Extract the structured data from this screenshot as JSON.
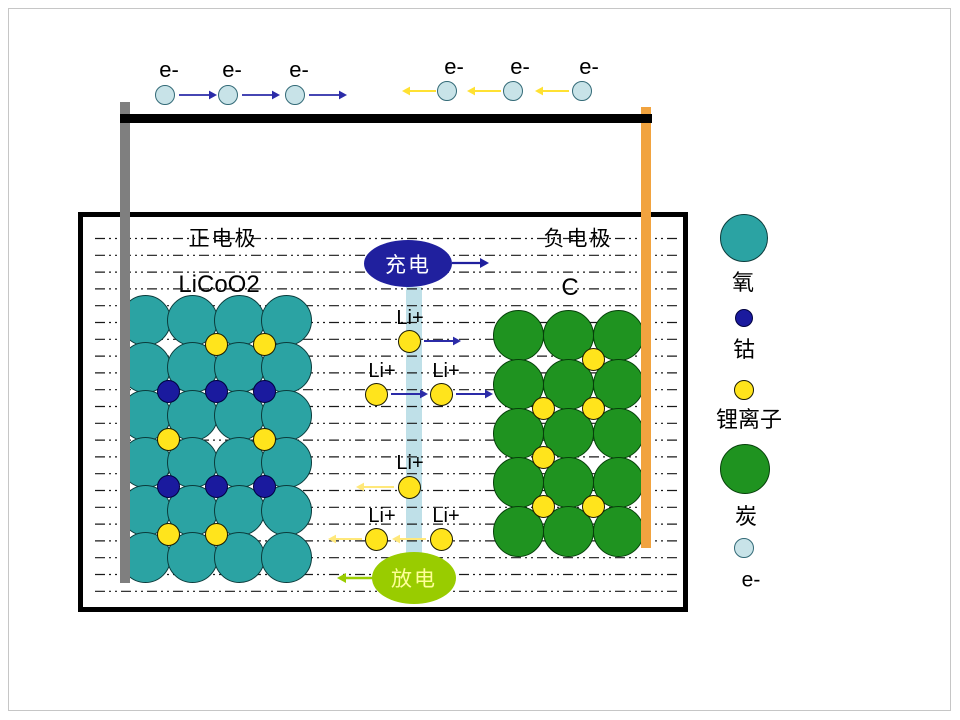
{
  "labels": {
    "positive_title": "正电极",
    "positive_formula": "LiCoO2",
    "negative_title": "负电极",
    "negative_formula": "C",
    "charge": "充电",
    "discharge": "放电",
    "ion": "Li+",
    "electron": "e-"
  },
  "colors": {
    "wire": "#000000",
    "collector_left": "#7F7F7F",
    "collector_right": "#F1A33F",
    "separator": "#BFE0E8",
    "charge_fill": "#20209E",
    "charge_text": "#FFFFFF",
    "discharge_fill": "#99CC00",
    "discharge_text": "#FFFF99",
    "dash_line": "#1A1A1A",
    "oxygen": "#2BA3A3",
    "cobalt": "#1A1A9E",
    "lithium": "#FFE41C",
    "carbon": "#1F9320",
    "electron": "#C8E3E8"
  },
  "lattices": {
    "positive": {
      "atom": "oxygen-atom",
      "fill": "#2BA3A3",
      "stroke": "#0B3C3C",
      "r": 25.5,
      "cols": [
        145,
        192,
        239,
        286
      ],
      "rows": [
        320,
        367.5,
        415,
        462.5,
        510,
        557.5
      ],
      "interstitials": [
        {
          "x": 216,
          "y": 344,
          "type": "lithium-ion"
        },
        {
          "x": 264,
          "y": 344,
          "type": "lithium-ion"
        },
        {
          "x": 168,
          "y": 391.5,
          "type": "cobalt-atom"
        },
        {
          "x": 216,
          "y": 391.5,
          "type": "cobalt-atom"
        },
        {
          "x": 264,
          "y": 391.5,
          "type": "cobalt-atom"
        },
        {
          "x": 168,
          "y": 439,
          "type": "lithium-ion"
        },
        {
          "x": 264,
          "y": 439,
          "type": "lithium-ion"
        },
        {
          "x": 168,
          "y": 486.5,
          "type": "cobalt-atom"
        },
        {
          "x": 216,
          "y": 486.5,
          "type": "cobalt-atom"
        },
        {
          "x": 264,
          "y": 486.5,
          "type": "cobalt-atom"
        },
        {
          "x": 168,
          "y": 534,
          "type": "lithium-ion"
        },
        {
          "x": 216,
          "y": 534,
          "type": "lithium-ion"
        }
      ]
    },
    "negative": {
      "atom": "carbon-atom",
      "fill": "#1F9320",
      "stroke": "#06400A",
      "r": 25.5,
      "cols": [
        518,
        568,
        618
      ],
      "rows": [
        335,
        384,
        433,
        482,
        531
      ],
      "interstitials": [
        {
          "x": 593,
          "y": 359.5,
          "type": "lithium-ion"
        },
        {
          "x": 543,
          "y": 408.5,
          "type": "lithium-ion"
        },
        {
          "x": 593,
          "y": 408.5,
          "type": "lithium-ion"
        },
        {
          "x": 543,
          "y": 457.5,
          "type": "lithium-ion"
        },
        {
          "x": 543,
          "y": 506.5,
          "type": "lithium-ion"
        },
        {
          "x": 593,
          "y": 506.5,
          "type": "lithium-ion"
        }
      ]
    }
  },
  "ion_styles": {
    "lithium-ion": {
      "fill": "#FFE41C",
      "stroke": "#1A1A00",
      "r": 11.5
    },
    "cobalt-atom": {
      "fill": "#1A1A9E",
      "stroke": "#00003F",
      "r": 11.5
    },
    "electron-circle": {
      "fill": "#C8E3E8",
      "stroke": "#336A77",
      "r": 10
    }
  },
  "electron_flow": {
    "left": {
      "circles": [
        [
          165,
          95
        ],
        [
          228,
          95
        ],
        [
          295,
          95
        ]
      ],
      "labels": [
        [
          169,
          70
        ],
        [
          232,
          70
        ],
        [
          299,
          70
        ]
      ]
    },
    "right": {
      "circles": [
        [
          447,
          91
        ],
        [
          513,
          91
        ],
        [
          582,
          91
        ]
      ],
      "labels": [
        [
          454,
          67
        ],
        [
          520,
          67
        ],
        [
          589,
          67
        ]
      ]
    }
  },
  "li_migration": {
    "charge": [
      {
        "lx": 410,
        "ly": 318,
        "cx": 409,
        "cy": 341
      },
      {
        "lx": 382,
        "ly": 371,
        "cx": 376,
        "cy": 394
      },
      {
        "lx": 446,
        "ly": 371,
        "cx": 441,
        "cy": 394
      }
    ],
    "discharge": [
      {
        "lx": 410,
        "ly": 463,
        "cx": 409,
        "cy": 487
      },
      {
        "lx": 382,
        "ly": 516,
        "cx": 376,
        "cy": 539
      },
      {
        "lx": 446,
        "ly": 516,
        "cx": 441,
        "cy": 539
      }
    ]
  },
  "arrows": [
    {
      "name": "electron-arrow-right",
      "x1": 179,
      "y1": 95,
      "x2": 217,
      "y2": 95,
      "color": "#2B2BA8",
      "w": 1.8,
      "head": 8
    },
    {
      "name": "electron-arrow-right",
      "x1": 242,
      "y1": 95,
      "x2": 280,
      "y2": 95,
      "color": "#2B2BA8",
      "w": 1.8,
      "head": 8
    },
    {
      "name": "electron-arrow-right",
      "x1": 309,
      "y1": 95,
      "x2": 347,
      "y2": 95,
      "color": "#2B2BA8",
      "w": 1.8,
      "head": 8
    },
    {
      "name": "electron-arrow-left",
      "x1": 436,
      "y1": 91,
      "x2": 402,
      "y2": 91,
      "color": "#FFE132",
      "w": 2,
      "head": 8
    },
    {
      "name": "electron-arrow-left",
      "x1": 501,
      "y1": 91,
      "x2": 467,
      "y2": 91,
      "color": "#FFE132",
      "w": 2,
      "head": 8
    },
    {
      "name": "electron-arrow-left",
      "x1": 569,
      "y1": 91,
      "x2": 535,
      "y2": 91,
      "color": "#FFE132",
      "w": 2,
      "head": 8
    },
    {
      "name": "charge-arrow",
      "x1": 452,
      "y1": 263,
      "x2": 489,
      "y2": 263,
      "color": "#20209E",
      "w": 2.2,
      "head": 9
    },
    {
      "name": "li-arrow-charge",
      "x1": 424,
      "y1": 341,
      "x2": 461,
      "y2": 341,
      "color": "#2B2BA8",
      "w": 2,
      "head": 8
    },
    {
      "name": "li-arrow-charge",
      "x1": 391,
      "y1": 394,
      "x2": 428,
      "y2": 394,
      "color": "#2B2BA8",
      "w": 2,
      "head": 8
    },
    {
      "name": "li-arrow-charge",
      "x1": 456,
      "y1": 394,
      "x2": 493,
      "y2": 394,
      "color": "#2B2BA8",
      "w": 2,
      "head": 8
    },
    {
      "name": "li-arrow-discharge",
      "x1": 394,
      "y1": 487,
      "x2": 356,
      "y2": 487,
      "color": "#FFE87A",
      "w": 2,
      "head": 8
    },
    {
      "name": "li-arrow-discharge",
      "x1": 362,
      "y1": 539,
      "x2": 328,
      "y2": 539,
      "color": "#FFE87A",
      "w": 2,
      "head": 8
    },
    {
      "name": "li-arrow-discharge",
      "x1": 426,
      "y1": 539,
      "x2": 392,
      "y2": 539,
      "color": "#FFE87A",
      "w": 2,
      "head": 8
    },
    {
      "name": "discharge-arrow",
      "x1": 374,
      "y1": 578,
      "x2": 337,
      "y2": 578,
      "color": "#99CC00",
      "w": 2.4,
      "head": 9
    }
  ],
  "dashed_lines": {
    "x1": 95,
    "x2": 680,
    "y_start": 238.5,
    "step": 16.8,
    "count": 22
  },
  "geometry": {
    "left_collector": {
      "x": 120,
      "y": 102,
      "w": 10,
      "h": 481
    },
    "right_collector": {
      "x": 641,
      "y": 107,
      "w": 10,
      "h": 441
    },
    "top_wire": {
      "x": 120,
      "y": 114,
      "w": 532,
      "h": 9
    },
    "separator": {
      "x": 406,
      "y": 287,
      "w": 16,
      "h": 272
    }
  },
  "legend": [
    {
      "id": "oxygen",
      "label": "氧",
      "color": "#2BA3A3",
      "stroke": "#0B3C3C",
      "cx": 744,
      "cy": 238,
      "r": 24,
      "lx": 743,
      "ly": 283,
      "cn": true
    },
    {
      "id": "cobalt",
      "label": "钴",
      "color": "#1A1A9E",
      "stroke": "#00003F",
      "cx": 744,
      "cy": 318,
      "r": 9,
      "lx": 744,
      "ly": 350,
      "cn": true
    },
    {
      "id": "lithium-ion",
      "label": "锂离子",
      "color": "#FFE41C",
      "stroke": "#1A1A00",
      "cx": 744,
      "cy": 390,
      "r": 10,
      "lx": 749,
      "ly": 420,
      "cn": true
    },
    {
      "id": "carbon",
      "label": "炭",
      "color": "#1F9320",
      "stroke": "#06400A",
      "cx": 745,
      "cy": 469,
      "r": 25,
      "lx": 746,
      "ly": 517,
      "cn": true
    },
    {
      "id": "electron",
      "label": "e-",
      "color": "#C8E3E8",
      "stroke": "#336A77",
      "cx": 744,
      "cy": 548,
      "r": 10,
      "lx": 751,
      "ly": 580,
      "cn": false
    }
  ]
}
